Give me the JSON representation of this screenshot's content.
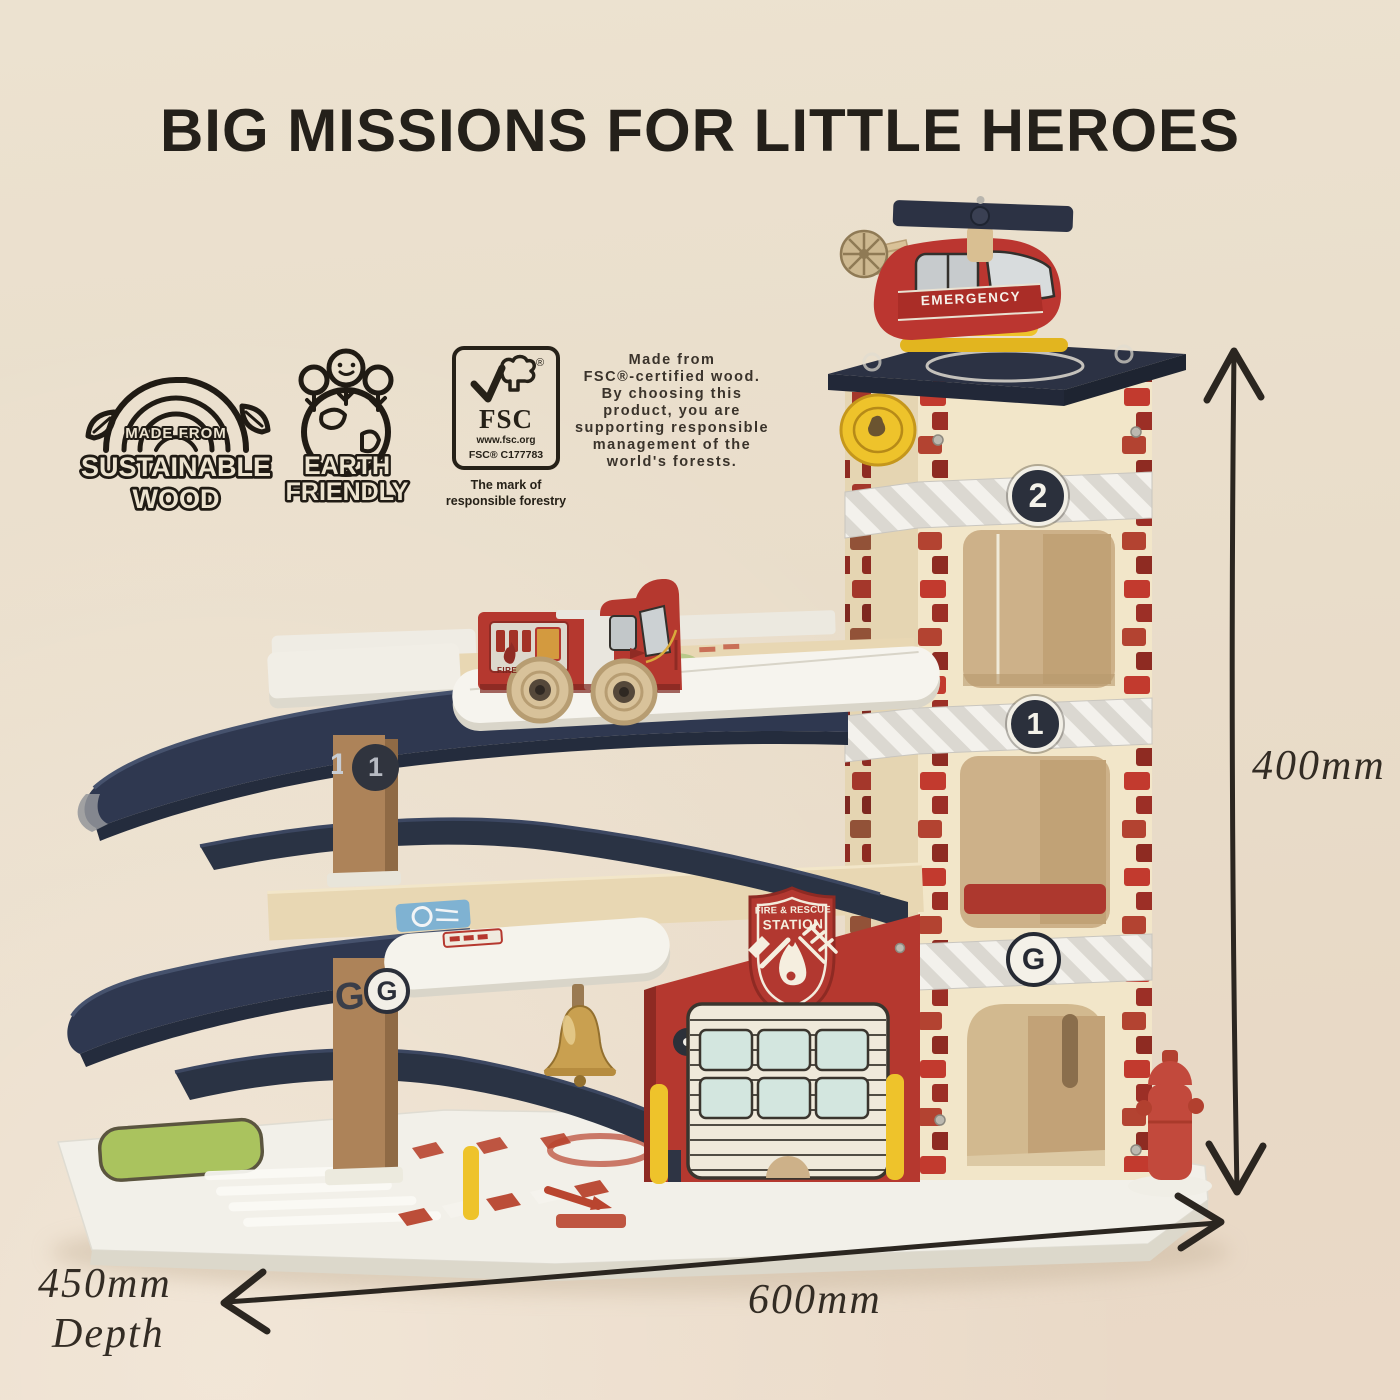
{
  "title": "BIG MISSIONS FOR LITTLE HEROES",
  "eco_badges": {
    "sustainable_wood": {
      "top": "MADE FROM",
      "middle": "SUSTAINABLE",
      "bottom": "WOOD"
    },
    "earth_friendly": {
      "top": "EARTH",
      "bottom": "FRIENDLY"
    }
  },
  "fsc": {
    "name": "FSC",
    "registered_mark": "®",
    "url": "www.fsc.org",
    "license": "FSC® C177783",
    "caption_line1": "The mark of",
    "caption_line2": "responsible forestry",
    "description_lines": [
      "Made from",
      "FSC®-certified wood.",
      "By choosing this",
      "product, you are",
      "supporting responsible",
      "management of the",
      "world's forests."
    ]
  },
  "dimensions": {
    "height": "400mm",
    "width": "600mm",
    "depth": "450mm",
    "depth_label": "Depth"
  },
  "toy": {
    "helicopter_label": "EMERGENCY",
    "truck_label": "FIRE",
    "station_shield": {
      "line1": "FIRE & RESCUE",
      "line2": "STATION"
    },
    "floors": {
      "second": "2",
      "first": "1",
      "ground": "G"
    },
    "pillar_first": "1",
    "pillar_ground": "G"
  },
  "colors": {
    "background": "#e9decb",
    "ink": "#24201a",
    "brick_red": "#c23a2e",
    "station_red": "#b5382f",
    "ramp_navy": "#2f3850",
    "tower_cream": "#f2e6c9",
    "deck_white": "#f5f3ed",
    "accent_yellow": "#eec32b",
    "bell_gold": "#c9a050",
    "grass_green": "#aac35e",
    "window_blue": "#d3e6df"
  }
}
